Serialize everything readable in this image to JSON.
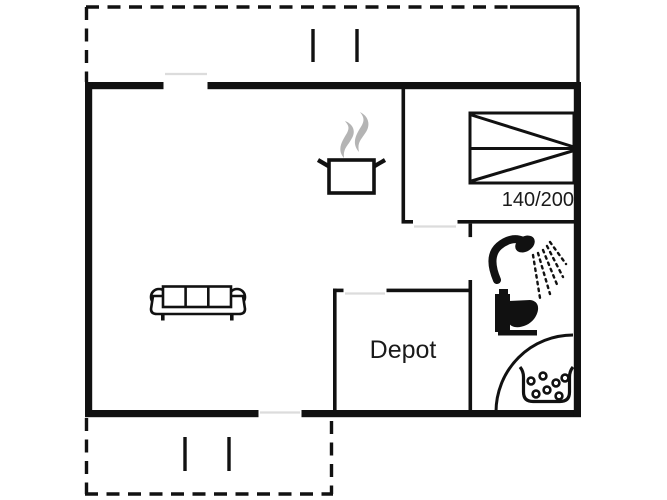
{
  "floorplan": {
    "labels": {
      "bed_size": "140/200",
      "depot": "Depot"
    },
    "colors": {
      "wall": "#111111",
      "steam_gray": "#b4b4b4",
      "door_sill_gray": "#dcdcdc",
      "background": "#ffffff",
      "label_text": "#1a1a1a"
    },
    "icons": [
      "double-bed-icon",
      "cooking-pot-icon",
      "steam-icon",
      "sofa-icon",
      "shower-icon",
      "toilet-icon",
      "washbasin-icon",
      "door-swing-arc",
      "terrace-post-marker"
    ]
  }
}
